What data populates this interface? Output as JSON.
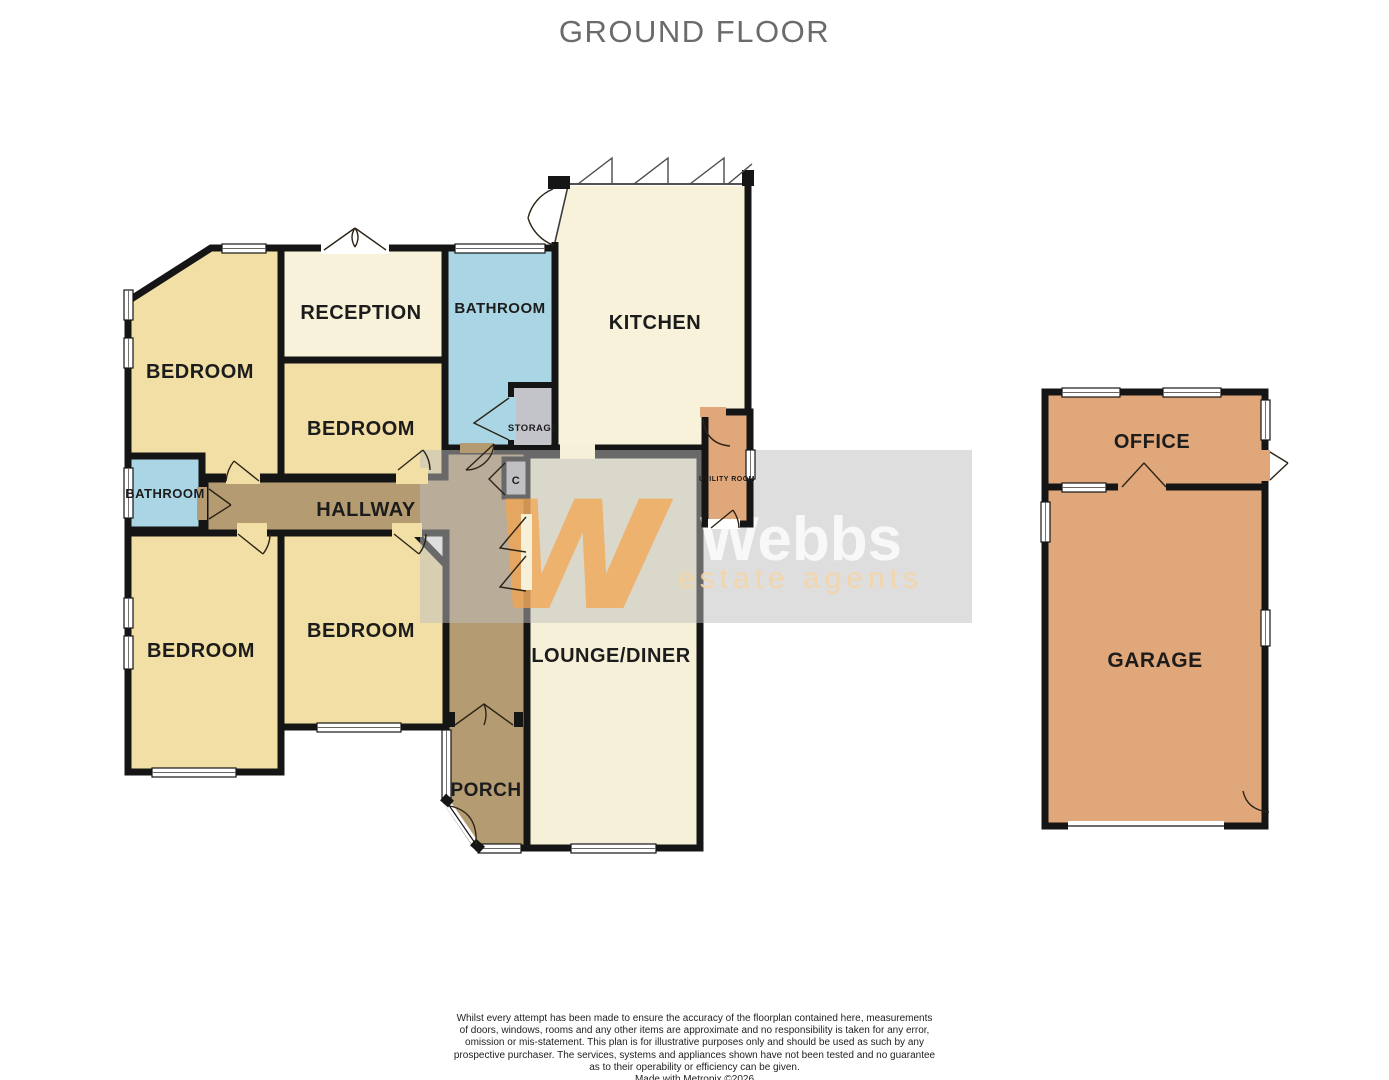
{
  "title": "GROUND FLOOR",
  "rooms": {
    "bedroom_top_left": "BEDROOM",
    "reception": "RECEPTION",
    "bedroom_middle": "BEDROOM",
    "bathroom_top": "BATHROOM",
    "storage": "STORAGE",
    "kitchen": "KITCHEN",
    "utility": "UTILITY ROOM",
    "bathroom_left": "BATHROOM",
    "hallway": "HALLWAY",
    "cupboard": "C",
    "bedroom_bottom_left": "BEDROOM",
    "bedroom_bottom_middle": "BEDROOM",
    "lounge": "LOUNGE/DINER",
    "porch": "PORCH",
    "office": "OFFICE",
    "garage": "GARAGE"
  },
  "watermark": {
    "monogram": "w",
    "name": "Webbs",
    "tagline": "estate agents"
  },
  "disclaimer": {
    "lines": [
      "Whilst every attempt has been made to ensure the accuracy of the floorplan contained here, measurements",
      "of doors, windows, rooms and any other items are approximate and no responsibility is taken for any error,",
      "omission or mis-statement. This plan is for illustrative purposes only and should be used as such by any",
      "prospective purchaser. The services, systems and appliances shown have not been tested and no guarantee",
      "as to their operability or efficiency can be given.",
      "Made with Metropix ©2026"
    ]
  },
  "colors": {
    "room_yellow": "#f2dfa5",
    "room_cream": "#f9f2da",
    "room_blue": "#a9d5e4",
    "room_brown": "#b59b72",
    "room_orange": "#e0a77a",
    "room_gray": "#c3c3ca",
    "wall": "#151515",
    "title_gray": "#6b6b6b",
    "logo_orange": "#f6a54c"
  }
}
